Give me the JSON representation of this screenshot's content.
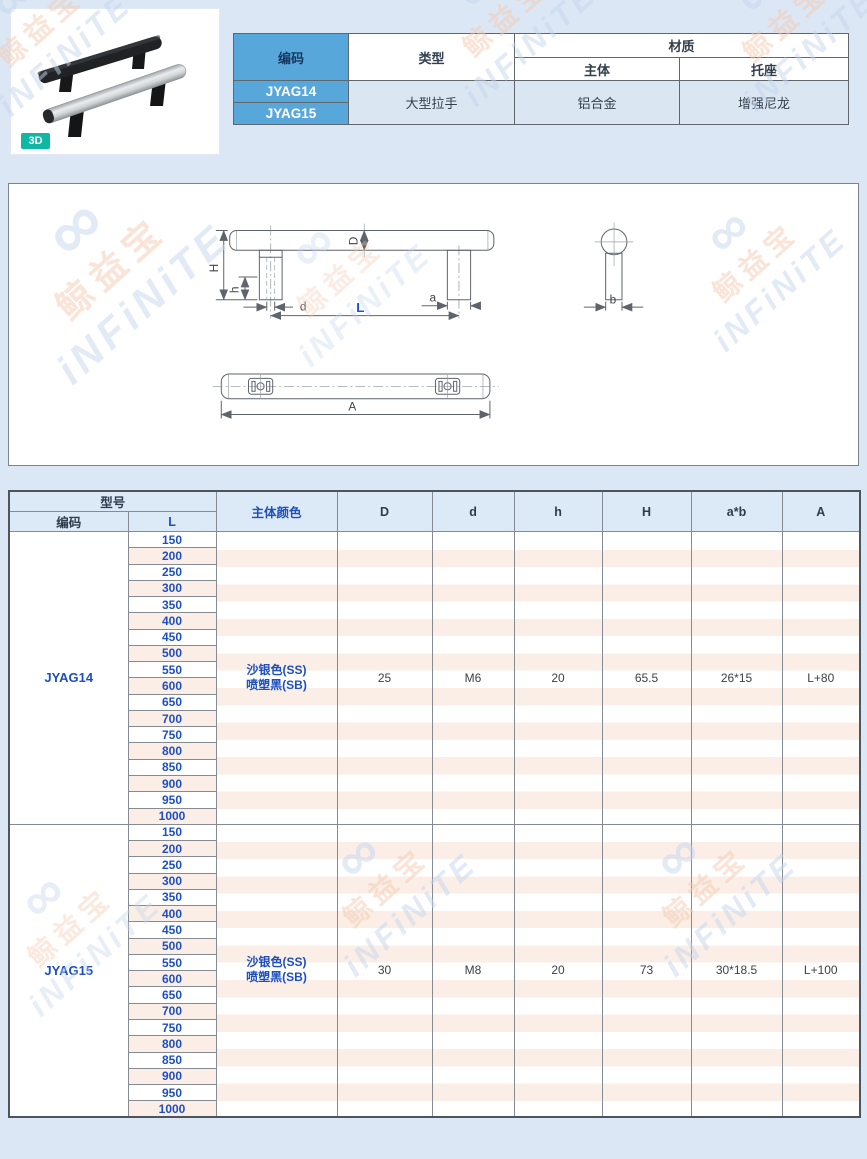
{
  "watermark": {
    "brand": "鲸益宝",
    "logo": "iNFiNiTE",
    "symbol": "∞"
  },
  "product": {
    "badge": "3D",
    "info": {
      "code_header": "编码",
      "type_header": "类型",
      "material_header": "材质",
      "material_body": "主体",
      "material_bracket": "托座",
      "codes": [
        "JYAG14",
        "JYAG15"
      ],
      "type_value": "大型拉手",
      "body_value": "铝合金",
      "bracket_value": "增强尼龙"
    }
  },
  "drawing": {
    "labels": {
      "H": "H",
      "h": "h",
      "D": "D",
      "d": "d",
      "L": "L",
      "a": "a",
      "b": "b",
      "A": "A"
    }
  },
  "spec": {
    "header": {
      "model": "型号",
      "code": "编码",
      "length": "L",
      "color": "主体颜色",
      "D": "D",
      "d": "d",
      "h": "h",
      "H": "H",
      "ab": "a*b",
      "A": "A"
    },
    "blocks": [
      {
        "code": "JYAG14",
        "color1": "沙银色(SS)",
        "color2": "喷塑黑(SB)",
        "D": "25",
        "d": "M6",
        "h": "20",
        "H": "65.5",
        "ab": "26*15",
        "A": "L+80",
        "lengths": [
          "150",
          "200",
          "250",
          "300",
          "350",
          "400",
          "450",
          "500",
          "550",
          "600",
          "650",
          "700",
          "750",
          "800",
          "850",
          "900",
          "950",
          "1000"
        ]
      },
      {
        "code": "JYAG15",
        "color1": "沙银色(SS)",
        "color2": "喷塑黑(SB)",
        "D": "30",
        "d": "M8",
        "h": "20",
        "H": "73",
        "ab": "30*18.5",
        "A": "L+100",
        "lengths": [
          "150",
          "200",
          "250",
          "300",
          "350",
          "400",
          "450",
          "500",
          "550",
          "600",
          "650",
          "700",
          "750",
          "800",
          "850",
          "900",
          "950",
          "1000"
        ]
      }
    ]
  }
}
